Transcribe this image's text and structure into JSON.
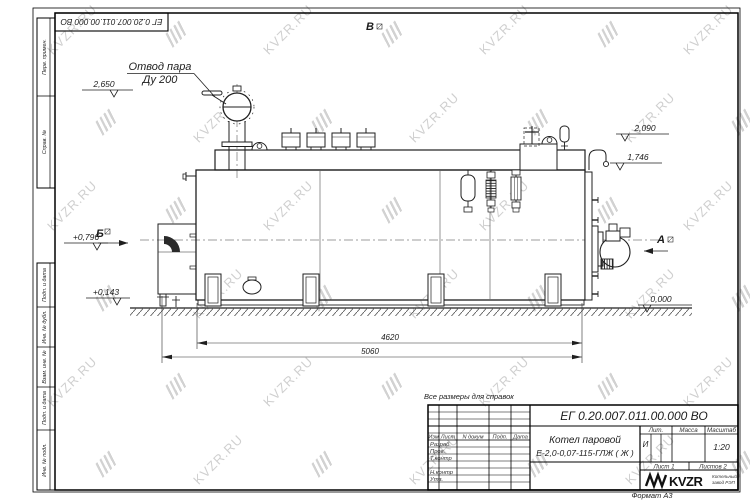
{
  "sheet": {
    "watermark_text": "KVZR.RU",
    "format_note": "Формат А3",
    "reference_note": "Все размеры для справок",
    "doc_number_top": "ЕГ 0.20.007.011.00.000  ВО"
  },
  "frame_columns": {
    "top": [
      "Перв. примен.",
      "Справ. №"
    ],
    "bottom": [
      "Подп. и дата",
      "Инв. № дубл.",
      "Взам. инв. №",
      "Подп. и дата",
      "Инв. № подл."
    ]
  },
  "drawing": {
    "callout_line1": "Отвод пара",
    "callout_line2": "Ду 200",
    "elevation_top": "2,650",
    "elevation_right_upper": "2,090",
    "elevation_right_lower": "1,746",
    "elevation_zero": "0,000",
    "elevation_left_upper": "+0,796",
    "elevation_left_lower": "+0,143",
    "dim_inner": "4620",
    "dim_overall": "5060",
    "view_a": "А",
    "view_b": "Б",
    "view_v": "В"
  },
  "title_block": {
    "doc_number": "ЕГ 0.20.007.011.00.000  ВО",
    "product_line1": "Котел паровой",
    "product_line2": "Е-2,0-0,07-115-ГЛЖ ( Ж )",
    "col_izm": "Изм",
    "col_list": "Лист",
    "col_ndoc": "N докум",
    "col_podp": "Подп.",
    "col_data": "Дата",
    "row_razrab": "Разраб.",
    "row_prov": "Пров.",
    "row_tkontr": "Т.контр",
    "row_nkontr": "Н.контр",
    "row_utv": "Утв.",
    "lit_label": "Лит.",
    "mass_label": "Масса",
    "scale_label": "Масштаб",
    "lit_value": "И",
    "scale_value": "1:20",
    "sheet_no": "Лист 1",
    "sheets_total": "Листов 2",
    "brand": "KVZR",
    "brand_sub1": "Котельный",
    "brand_sub2": "завод РЭП"
  }
}
